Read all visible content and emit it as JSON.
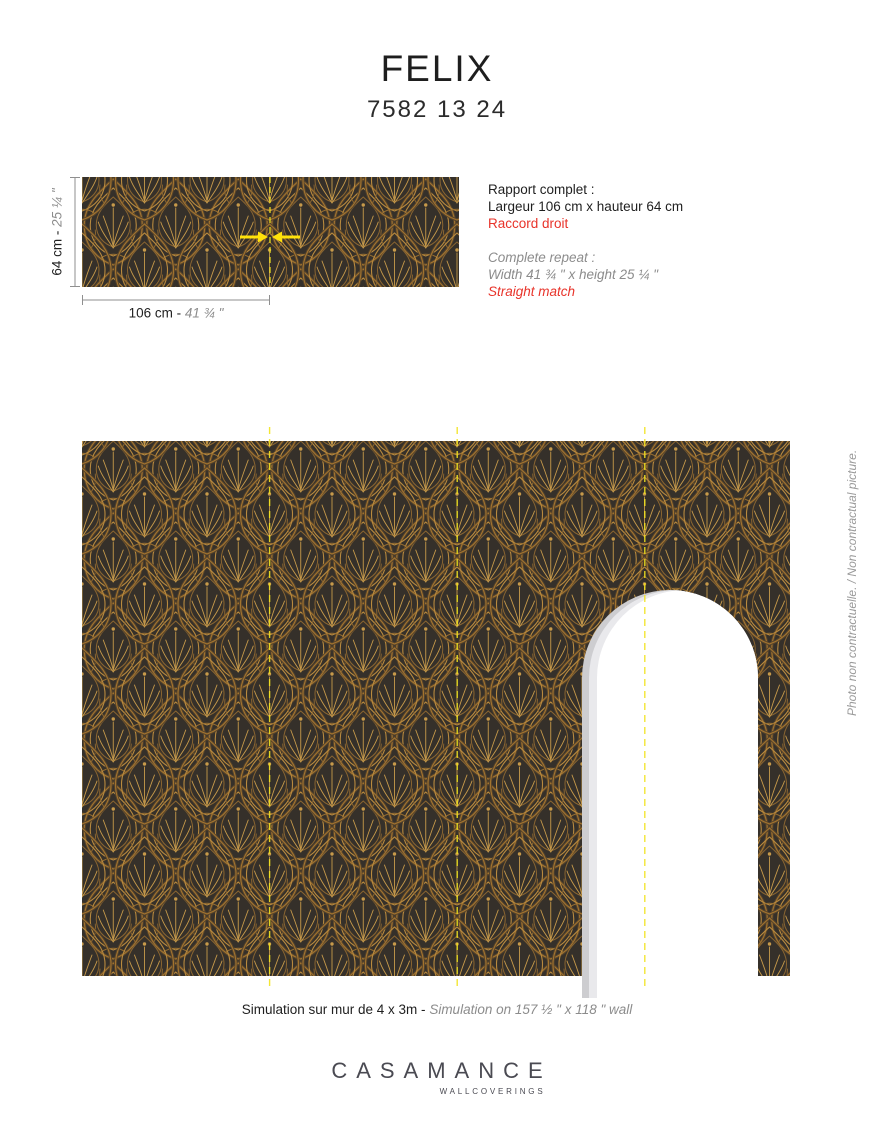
{
  "header": {
    "title": "FELIX",
    "code": "7582 13 24"
  },
  "repeat_swatch": {
    "height_metric": "64 cm - ",
    "height_imperial": "25 ¼ \"",
    "width_metric": "106 cm - ",
    "width_imperial": "41 ¾ \""
  },
  "repeat_info": {
    "fr_title": "Rapport complet :",
    "fr_size": "Largeur 106 cm x hauteur 64 cm",
    "fr_match": "Raccord droit",
    "en_title": "Complete repeat :",
    "en_size": "Width 41 ¾ \" x height 25 ¼ \"",
    "en_match": "Straight match"
  },
  "simulation": {
    "caption_fr": "Simulation sur mur de 4 x 3m - ",
    "caption_en": "Simulation on 157 ½ \" x 118 \" wall"
  },
  "side_note": "Photo non contractuelle. / Non contractual picture.",
  "brand": {
    "name": "CASAMANCE",
    "tagline": "WALLCOVERINGS"
  },
  "colors": {
    "accent_red": "#e8332a",
    "seam_yellow": "#f2e41f",
    "arrow_yellow": "#ffe20a",
    "pattern_background": "#35302a",
    "pattern_gold_light": "#c79a4a",
    "pattern_gold": "#a3742f",
    "pattern_gold_dark": "#6f5530",
    "dimension_line_gray": "#8f8f8f",
    "text_gray": "#8c8c8c",
    "brand_gray": "#4a4a52"
  }
}
